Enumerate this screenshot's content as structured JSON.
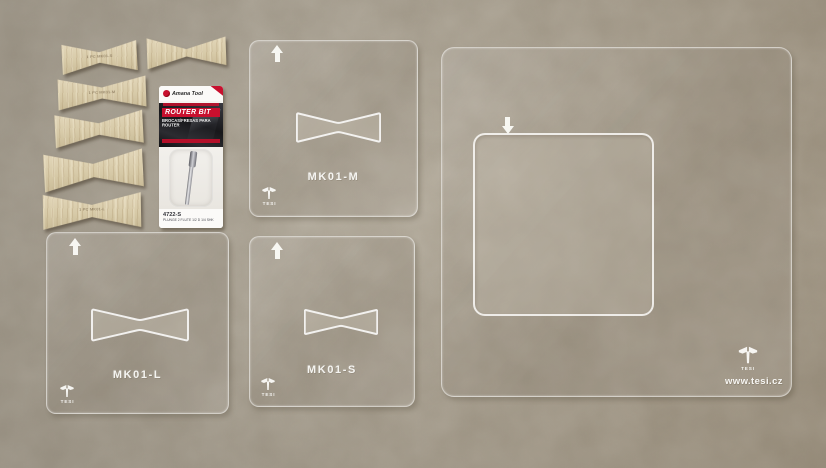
{
  "photo": {
    "brand": "TESI",
    "website": "www.tesi.cz"
  },
  "templates": {
    "medium": {
      "label": "MK01-M",
      "brand": "TESI"
    },
    "small": {
      "label": "MK01-S",
      "brand": "TESI"
    },
    "large_bowtie": {
      "label": "MK01-L",
      "brand": "TESI"
    },
    "square": {
      "brand": "TESI",
      "website": "www.tesi.cz"
    }
  },
  "bowties": {
    "row1": {
      "etched_label": "1 PC  MK01-S"
    },
    "row2": {
      "etched_label": "1 PC  MK01-M"
    },
    "row5": {
      "etched_label": "1 PC  MK01-L"
    }
  },
  "router_bit_package": {
    "brand": "Amana Tool",
    "title": "ROUTER BIT",
    "subtitle": "BROCAS/FRESAS PARA ROUTER",
    "part_number": "4722-S",
    "spec_line": "PLUNGE 2 FLUTE 1/2 D 1/4 SHK"
  },
  "colors": {
    "background": "#a59d8e",
    "wood": "#d7caa8",
    "acrylic_edge": "#fcfcf9",
    "package_red": "#c8102e",
    "package_dark": "#17171a"
  }
}
